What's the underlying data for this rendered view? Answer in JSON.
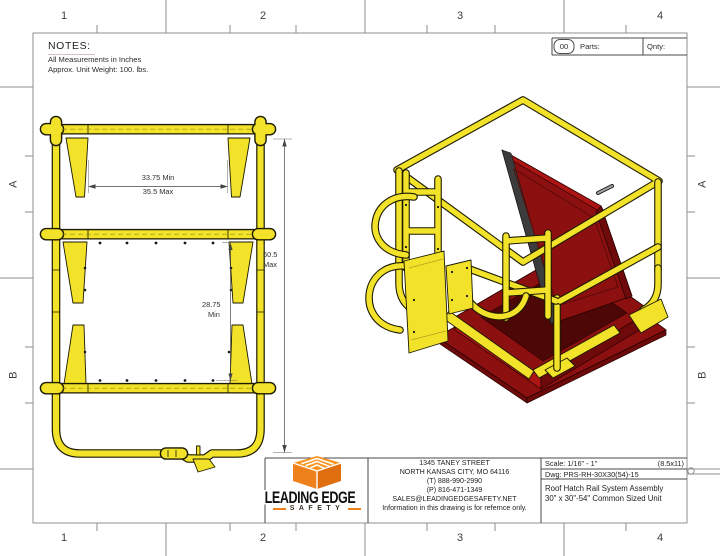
{
  "grid": {
    "top": [
      "1",
      "2",
      "3",
      "4"
    ],
    "bottom": [
      "1",
      "2",
      "3",
      "4"
    ],
    "left": [
      "A",
      "B"
    ],
    "right": [
      "A",
      "B"
    ]
  },
  "notes": {
    "heading": "NOTES:",
    "lines": [
      "All Measurements in Inches",
      "Approx. Unit Weight: 100. lbs."
    ]
  },
  "parts_box": {
    "number": "00",
    "parts_label": "Parts:",
    "qnty_label": "Qnty:"
  },
  "front_view": {
    "width_dim": {
      "min": "33.75 Min",
      "max": "35.5 Max"
    },
    "height_dim": {
      "value": "60.5",
      "qualifier": "Max"
    },
    "inner_dim": {
      "value": "28.75",
      "qualifier": "Min"
    }
  },
  "title_block": {
    "logo": {
      "name_line": "LEADING EDGE",
      "sub_line": "SAFETY",
      "icon": "orange-cube-icon"
    },
    "address_lines": [
      "1345 TANEY STREET",
      "NORTH KANSAS CITY, MO 64116",
      "(T) 888-990-2990",
      "(P) 816-471-1349",
      "SALES@LEADINGEDGESAFETY.NET",
      "Information in this drawing is for refernce only."
    ],
    "scale": "Scale: 1/16\" - 1\"",
    "sheet": "(8.5x11)",
    "dwg": "Dwg: PRS-RH-30X30(54)-15",
    "title_lines": [
      "Roof Hatch Rail System Assembly",
      "30\" x 30\"-54\" Common Sized Unit"
    ]
  },
  "colors": {
    "rail_yellow": "#F2E22A",
    "rail_outline": "#1C1A00",
    "hatch_red": "#8C1010",
    "hatch_red_bright": "#AD1515",
    "hatch_red_dark": "#6E0A0A",
    "gasket_gray": "#3C3C3C",
    "logo_orange": "#EF811C",
    "grid_line": "#8f8f8f"
  }
}
